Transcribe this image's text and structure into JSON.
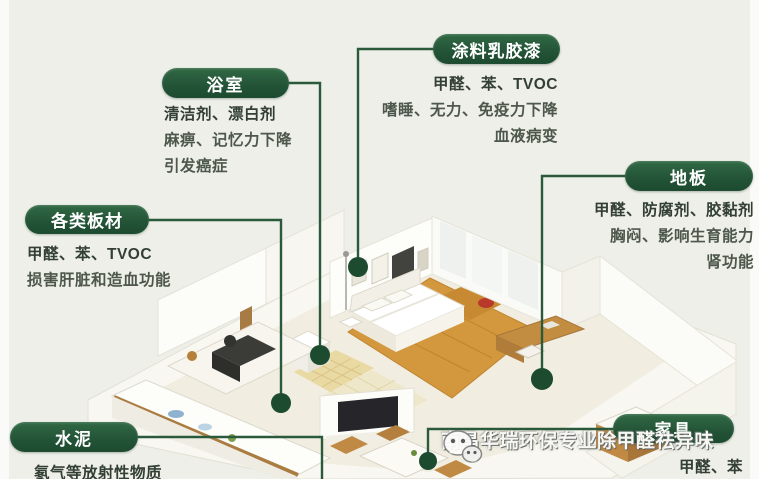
{
  "title": "室内污染源示意图",
  "callouts": [
    {
      "id": "bathroom",
      "label": "浴室",
      "lines": [
        "清洁剂、漂白剂",
        "麻痹、记忆力下降",
        "引发癌症"
      ]
    },
    {
      "id": "paint",
      "label": "涂料乳胶漆",
      "lines": [
        "甲醛、苯、TVOC",
        "嗜睡、无力、免疫力下降",
        "血液病变"
      ]
    },
    {
      "id": "floor",
      "label": "地板",
      "lines": [
        "甲醛、防腐剂、胶黏剂",
        "胸闷、影响生育能力",
        "肾功能"
      ]
    },
    {
      "id": "boards",
      "label": "各类板材",
      "lines": [
        "甲醛、苯、TVOC",
        "损害肝脏和造血功能"
      ]
    },
    {
      "id": "cement",
      "label": "水泥",
      "lines": [
        "氡气等放射性物质"
      ]
    },
    {
      "id": "furniture",
      "label": "家具",
      "lines": [
        "甲醛、苯"
      ]
    }
  ],
  "watermark": {
    "icon": "wechat-icon",
    "text": "南昌华瑞环保专业除甲醛祛异味"
  },
  "colors": {
    "background": "#edefe8",
    "pill_green": "#245538",
    "connector_green": "#2a5a3b",
    "dot_green": "#1d4b2f",
    "wood_floor": "#d3973d",
    "tile_yellow": "#e9d9a2",
    "accent_red": "#b93a2b"
  }
}
